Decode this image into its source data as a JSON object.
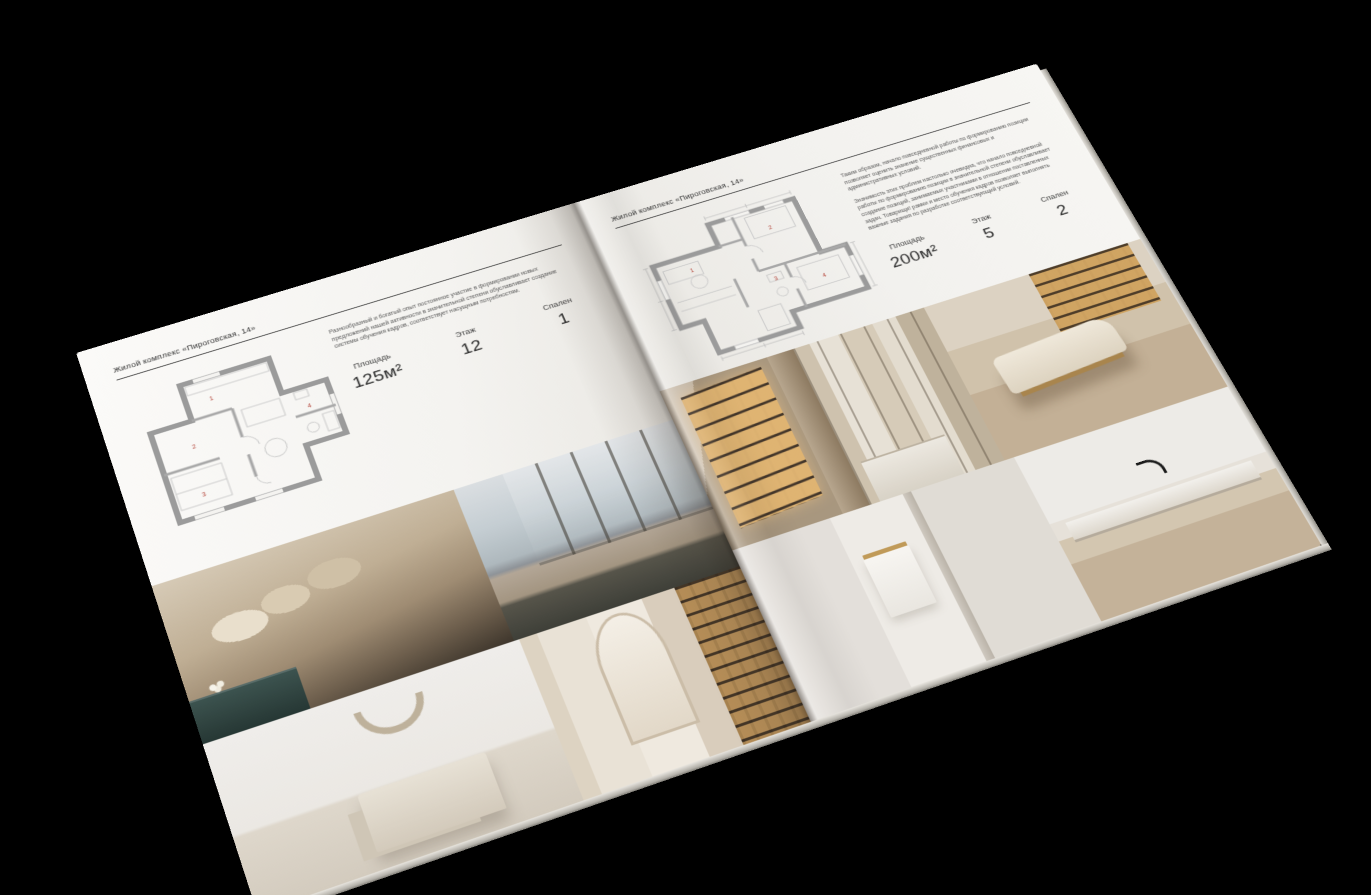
{
  "colors": {
    "background": "#000000",
    "paper": "#f2f1ee",
    "text": "#3c3c3c",
    "header_rule": "#3a3a3a",
    "plan_wall": "#9b9b9b",
    "plan_accent_red": "#b03a2e"
  },
  "left_page": {
    "header": "Жилой комплекс «Пироговская, 14»",
    "paragraph": "Разнообразный и богатый опыт постоянное участие в формировании новых предложений нашей активности в значительной степени обуславливает создание системы обучения кадров, соответствует насущным потребностям.",
    "stats": [
      {
        "label": "Площадь",
        "value": "125м²"
      },
      {
        "label": "Этаж",
        "value": "12"
      },
      {
        "label": "Спален",
        "value": "1"
      }
    ],
    "plan_markers": [
      "1",
      "2",
      "3",
      "4"
    ]
  },
  "right_page": {
    "header": "Жилой комплекс «Пироговская, 14»",
    "paragraphs": [
      "Таким образом, начало повседневной работы по формированию позиции позволяет оценить значение существенных финансовых и административных условий.",
      "Значимость этих проблем настолько очевидна, что начало повседневной работы по формированию позиции в значительной степени обуславливает создание позиций, занимаемых участниками в отношении поставленных задач. Товарищи! рамки и место обучения кадров позволяет выполнять важные задания по разработке соответствующий условий."
    ],
    "stats": [
      {
        "label": "Площадь",
        "value": "200м²"
      },
      {
        "label": "Этаж",
        "value": "5"
      },
      {
        "label": "Спален",
        "value": "2"
      }
    ],
    "plan_markers": [
      "1",
      "2",
      "3",
      "4"
    ]
  }
}
